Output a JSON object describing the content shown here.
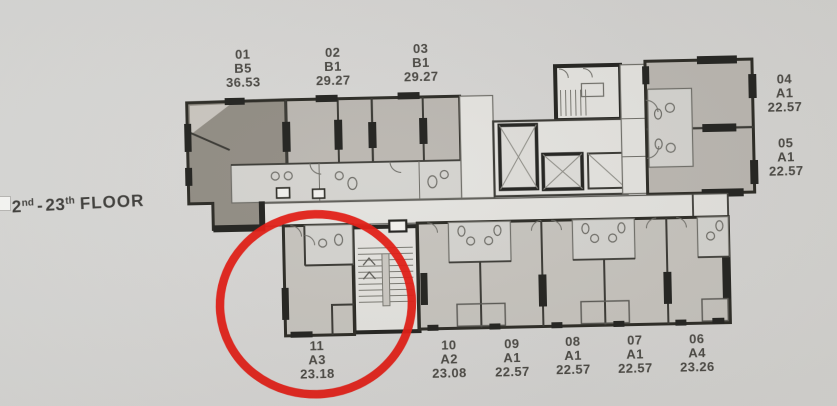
{
  "floor_label": {
    "n1": "2",
    "s1": "nd",
    "dash": "-",
    "n2": "23",
    "s2": "th",
    "word": "FLOOR"
  },
  "units": [
    {
      "no": "01",
      "type": "B5",
      "area": "36.53"
    },
    {
      "no": "02",
      "type": "B1",
      "area": "29.27"
    },
    {
      "no": "03",
      "type": "B1",
      "area": "29.27"
    },
    {
      "no": "04",
      "type": "A1",
      "area": "22.57"
    },
    {
      "no": "05",
      "type": "A1",
      "area": "22.57"
    },
    {
      "no": "06",
      "type": "A4",
      "area": "23.26"
    },
    {
      "no": "07",
      "type": "A1",
      "area": "22.57"
    },
    {
      "no": "08",
      "type": "A1",
      "area": "22.57"
    },
    {
      "no": "09",
      "type": "A1",
      "area": "22.57"
    },
    {
      "no": "10",
      "type": "A2",
      "area": "23.08"
    },
    {
      "no": "11",
      "type": "A3",
      "area": "23.18"
    }
  ],
  "highlight": {
    "highlighted_unit": "11",
    "circle_color": "#e2150d"
  },
  "colors": {
    "paper": "#d6d5d2",
    "wall": "#26251f",
    "unit_dark_fill": "#8f8a81",
    "unit_gray_fill": "#b9b5af",
    "room_pale_fill": "#e3e2de"
  }
}
